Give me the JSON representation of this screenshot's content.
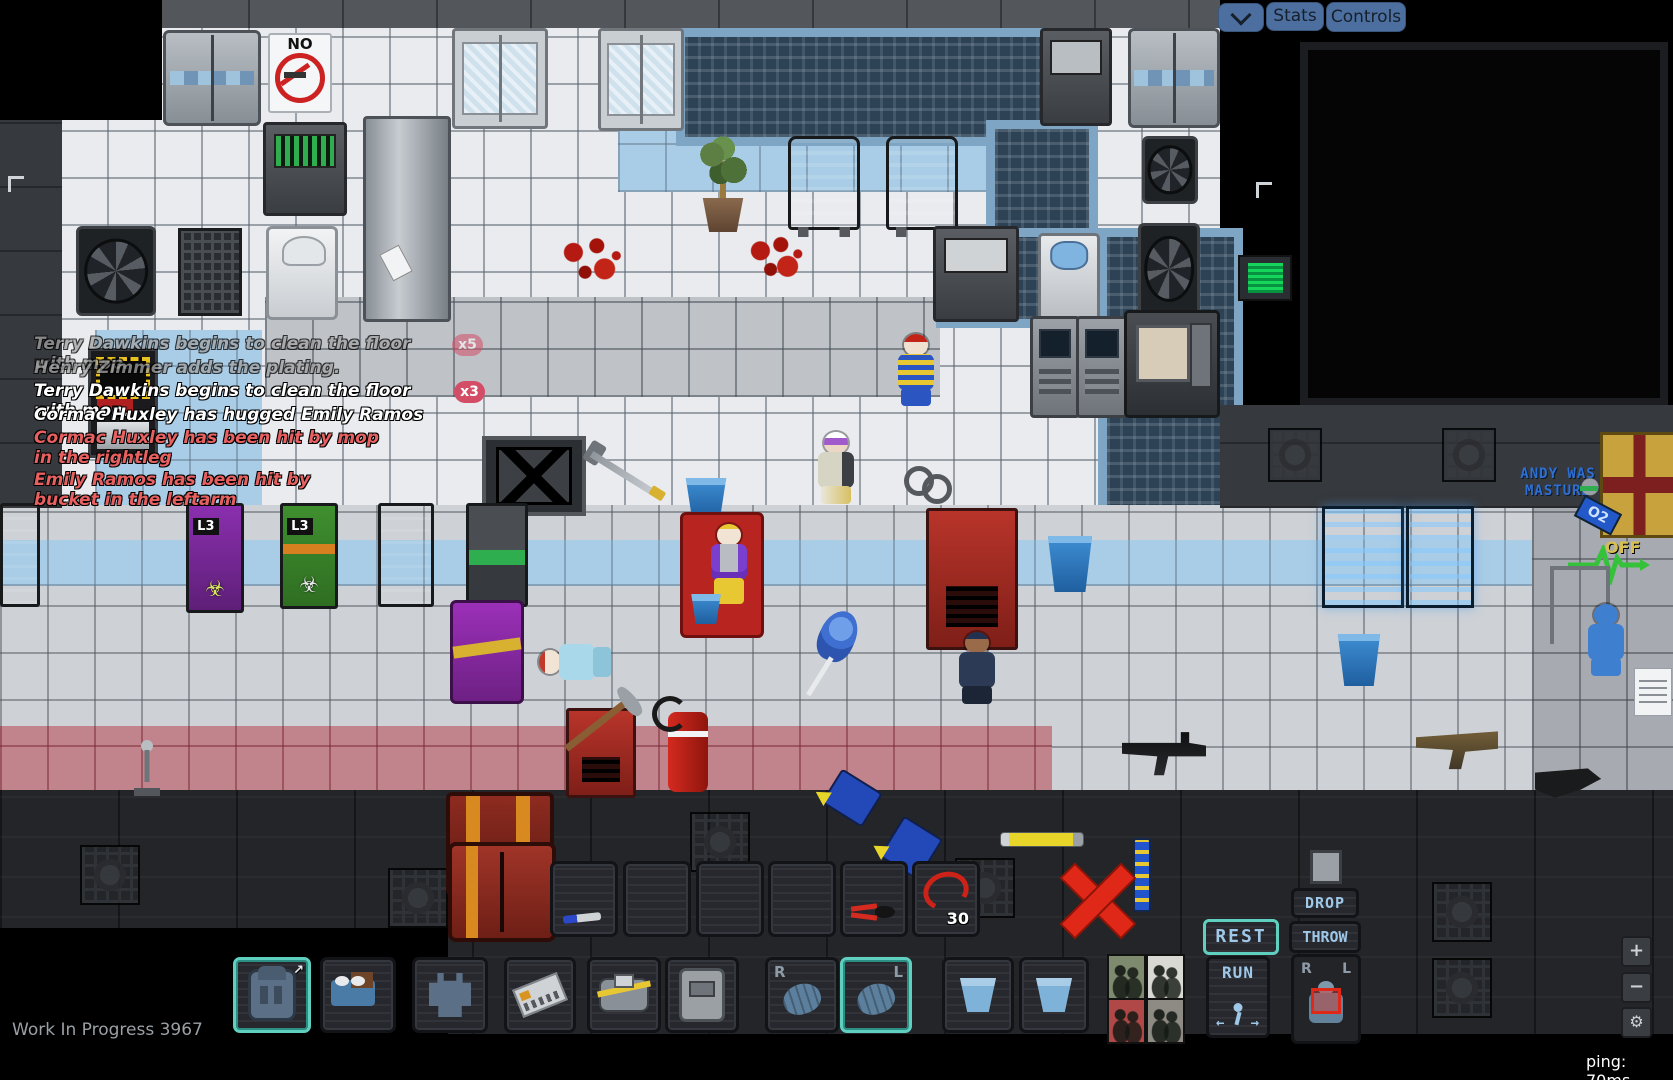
{
  "topbar": {
    "stats_label": "Stats",
    "controls_label": "Controls"
  },
  "chat": {
    "messages": [
      {
        "text": "Terry Dawkins begins to clean the floor with mop.",
        "style": "faded",
        "badge": "x5"
      },
      {
        "text": "Henry Zimmer adds the plating.",
        "style": "faded",
        "badge": ""
      },
      {
        "text": "Terry Dawkins begins to clean the floor with mop.",
        "style": "normal",
        "badge": "x3"
      },
      {
        "text": "Cormac Huxley has hugged Emily Ramos",
        "style": "normal",
        "badge": ""
      },
      {
        "text": "Cormac Huxley has been hit by mop in the rightleg",
        "style": "alert",
        "badge": ""
      },
      {
        "text": "Emily Ramos has been hit by bucket in the leftarm",
        "style": "alert",
        "badge": ""
      }
    ]
  },
  "world": {
    "no_smoking_label": "NO",
    "biohazard_symbol": "☣",
    "locker_purple_label": "L3",
    "locker_green_label": "L3",
    "graffiti_line1": "ANDY WAS",
    "graffiti_line2": "MASTURB",
    "canister_tag": "O2",
    "canister_off_label": "OFF",
    "objects": [
      "airlock-door",
      "no-smoking-sign",
      "vendor-monitor",
      "shower-column",
      "fan-vent",
      "grille-vent",
      "white-machine",
      "glass-double-door",
      "pool-mat",
      "potted-plant",
      "lounge-chair",
      "blood-splatter",
      "water-cooler",
      "atm-machine",
      "arcade-machine",
      "clown",
      "floor-drain",
      "mop",
      "bucket",
      "emily-ramos",
      "handcuffs",
      "biohazard-locker",
      "red-locker",
      "red-chair",
      "terry-dawkins",
      "blue-cabinet",
      "ekg-sensor",
      "iv-stand",
      "blue-suited-figure",
      "paper-note",
      "purple-cart",
      "lying-person",
      "feather-duster",
      "security-officer",
      "rifle",
      "tan-gun",
      "pickaxe",
      "fire-extinguisher",
      "supply-crate",
      "yellow-pen",
      "striped-rod",
      "oxygen-canister",
      "skull"
    ]
  },
  "hud": {
    "hotbar_slots": [
      {
        "item": "screwdriver",
        "count": ""
      },
      {
        "item": "",
        "count": ""
      },
      {
        "item": "",
        "count": ""
      },
      {
        "item": "",
        "count": ""
      },
      {
        "item": "wirecutters",
        "count": ""
      },
      {
        "item": "cable-coil",
        "count": "30"
      }
    ],
    "rest_label": "REST",
    "run_label": "RUN",
    "drop_label": "DROP",
    "throw_label": "THROW",
    "run_left_arrow": "←",
    "run_right_arrow": "→",
    "hand_right_label": "R",
    "hand_left_label": "L",
    "doll_right_label": "R",
    "doll_left_label": "L",
    "backpack_expand_icon": "↗"
  },
  "status": {
    "version": "Work In Progress 3967",
    "ping": "ping: 70ms"
  },
  "map_controls": {
    "zoom_in": "+",
    "zoom_out": "−",
    "settings_icon": "⚙"
  },
  "colors": {
    "accent_teal": "#5fd0c0",
    "button_blue": "#4c6f9f",
    "alert_red": "#e86060",
    "badge_red": "#d44d66",
    "graffiti_blue": "#2e6fd4"
  }
}
